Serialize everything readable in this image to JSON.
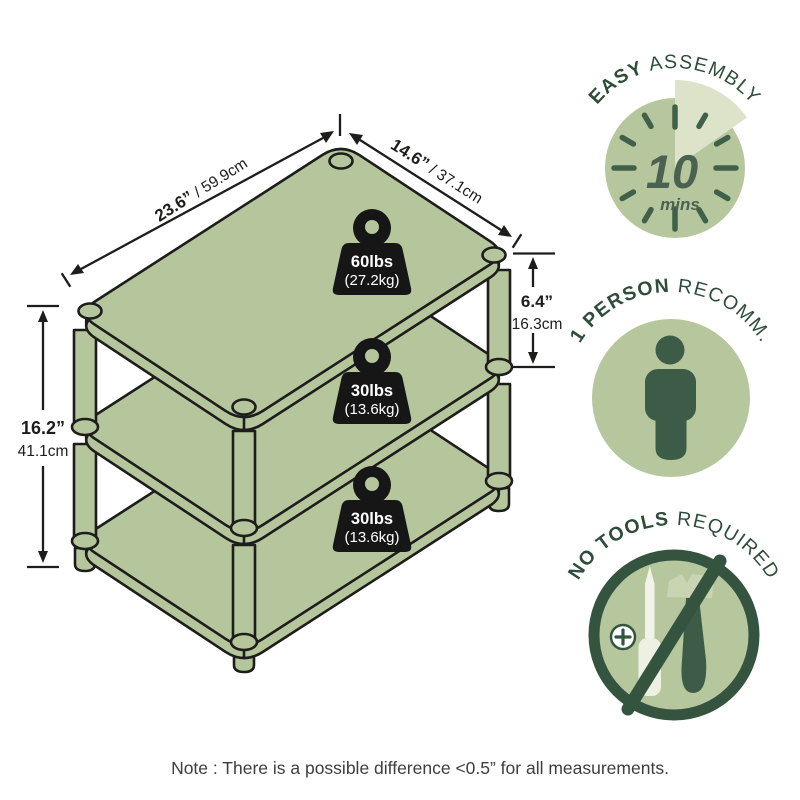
{
  "diagram": {
    "dimensions": {
      "width": {
        "inches": "23.6”",
        "cm": " / 59.9cm"
      },
      "depth": {
        "inches": "14.6”",
        "cm": " / 37.1cm"
      },
      "shelf_height": {
        "inches": "6.4”",
        "cm": "16.3cm"
      },
      "total_height": {
        "inches": "16.2”",
        "cm": "41.1cm"
      }
    },
    "capacities": {
      "top": {
        "lbs": "60lbs",
        "kg": "(27.2kg)"
      },
      "middle": {
        "lbs": "30lbs",
        "kg": "(13.6kg)"
      },
      "bottom": {
        "lbs": "30lbs",
        "kg": "(13.6kg)"
      }
    },
    "shelf_count": "3"
  },
  "badges": {
    "assembly": {
      "title_bold": "EASY",
      "title_rest": " ASSEMBLY",
      "minutes": "10",
      "unit": "mins"
    },
    "person": {
      "title_bold": "1 PERSON",
      "title_rest": " RECOMM."
    },
    "tools": {
      "title_bold": "NO TOOLS",
      "title_rest": " REQUIRED"
    }
  },
  "note": "Note : There is a possible difference <0.5” for all measurements.",
  "colors": {
    "shelf_sage": "#b5c69c",
    "badge_sage": "#b6c79d",
    "wedge_light": "#dce3c9",
    "title_green": "#2e4d39",
    "icon_green": "#3d5c48",
    "ring_green": "#35543f",
    "outline": "#1d1d1b",
    "weight_black": "#161616"
  }
}
